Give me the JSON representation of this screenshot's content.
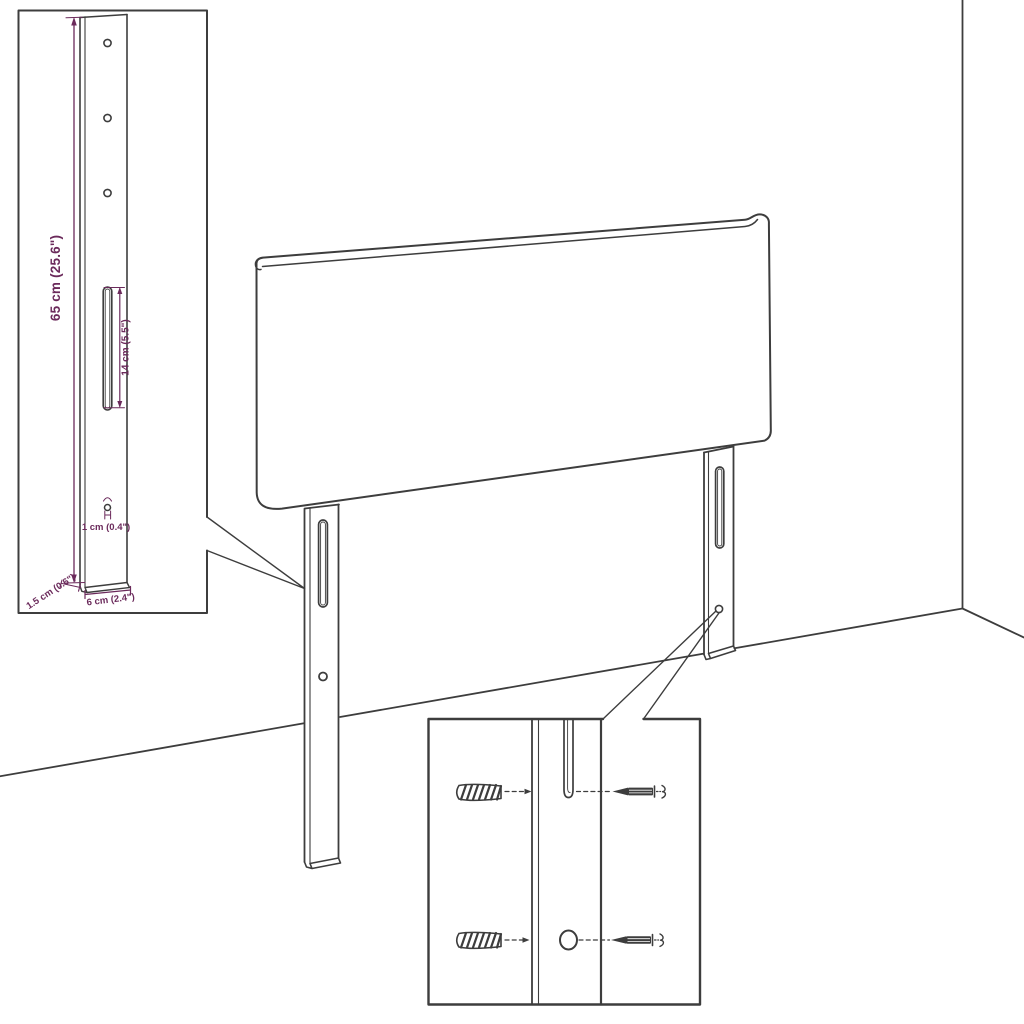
{
  "diagram": {
    "background": "#ffffff",
    "line_color": "#3d3d3d",
    "dimension_color": "#6b2a5b",
    "bracket_detail": {
      "labels": {
        "height": "65 cm (25.6\")",
        "slot_length": "14 cm (5.5\")",
        "hole_diameter": "1 cm (0.4\")",
        "thickness": "1.5 cm (0.6\")",
        "width": "6 cm (2.4\")"
      },
      "hole_count_top": 3,
      "hole_count_bottom": 1,
      "slot_count": 1
    },
    "headboard_view": {
      "legs": 2,
      "setting": "room corner"
    },
    "mounting_detail": {
      "rows": 2,
      "hardware": [
        "wall-plug",
        "screw"
      ]
    }
  }
}
